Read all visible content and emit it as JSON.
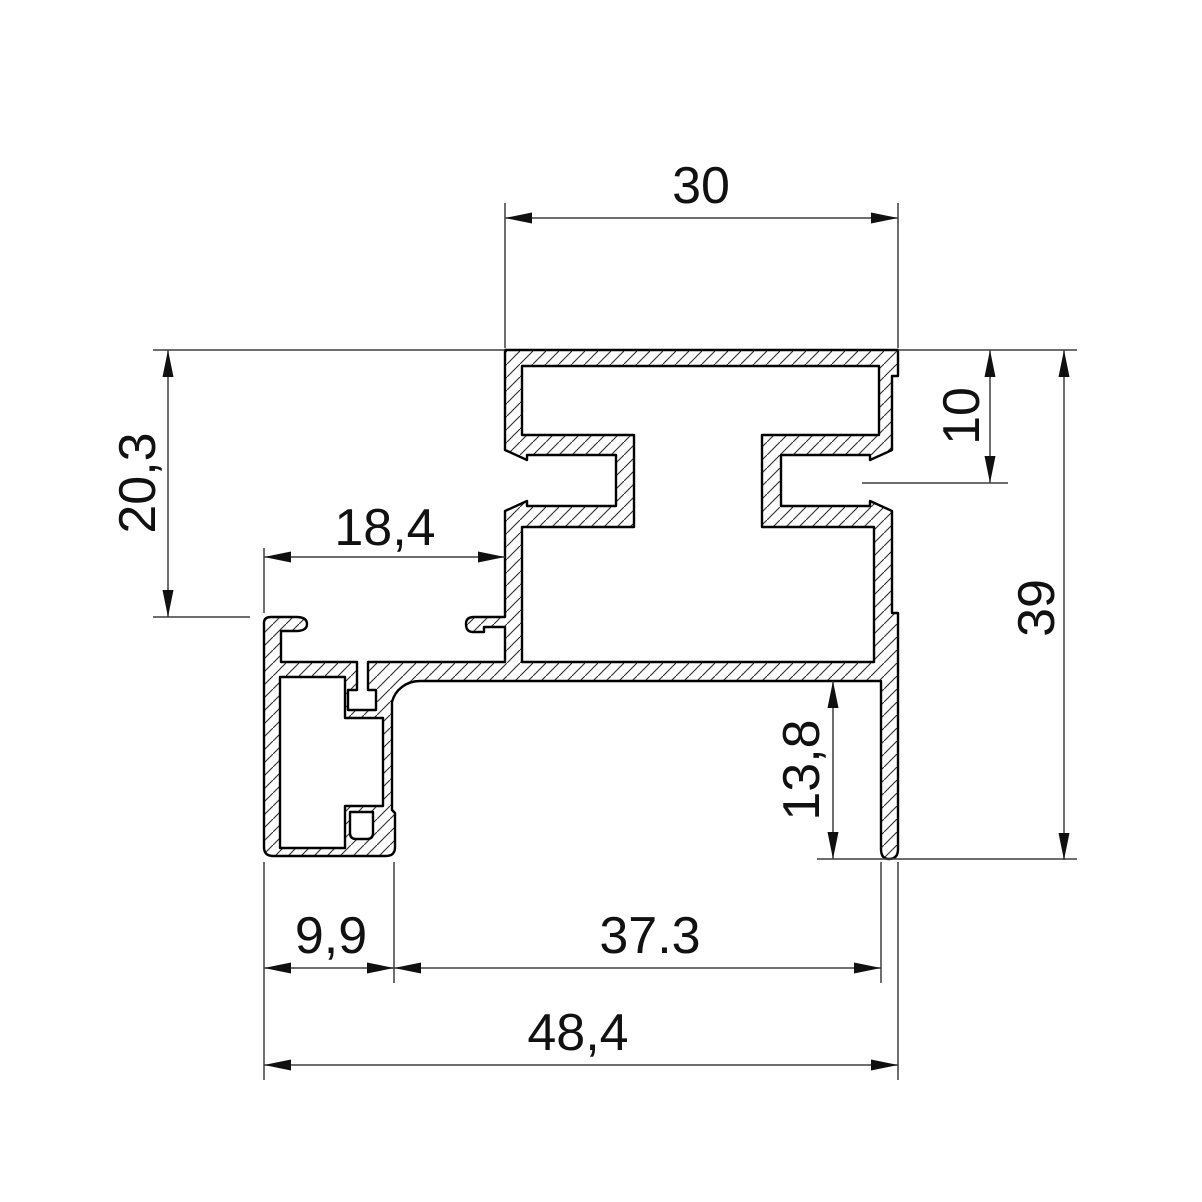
{
  "drawing": {
    "kind": "technical cross-section of aluminium extrusion profile",
    "units_shown": false,
    "dimensions": {
      "top_width": "30",
      "upper_left_height": "20,3",
      "rebate_width": "18,4",
      "groove_depth": "10",
      "overall_height": "39",
      "fin_height": "13,8",
      "box_width": "9,9",
      "web_width": "37.3",
      "total_width": "48,4"
    },
    "colors": {
      "background": "#ffffff",
      "outline": "#000000",
      "dimension_lines": "#3f3f3f",
      "hatch": "#2b2b2b",
      "text": "#111111"
    }
  }
}
